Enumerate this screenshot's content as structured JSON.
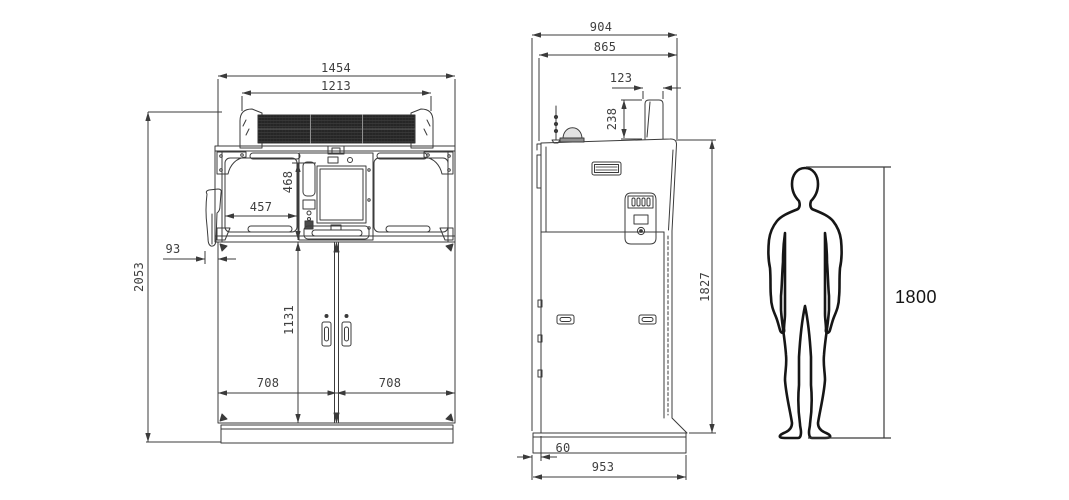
{
  "drawing": {
    "type": "technical-dimension-drawing",
    "units": "mm",
    "views": [
      "front view",
      "side view",
      "human figure scale reference"
    ]
  },
  "front_view": {
    "name": "Front view",
    "dims": {
      "overall_width": "1454",
      "grille_width": "1213",
      "overall_height": "2053",
      "console_panel_height": "468",
      "left_panel_width": "457",
      "holster_offset": "93",
      "door_height": "1131",
      "left_door_width": "708",
      "right_door_width": "708"
    }
  },
  "side_view": {
    "name": "Side view",
    "dims": {
      "overall_depth": "904",
      "body_depth": "865",
      "canopy_depth": "123",
      "canopy_height": "238",
      "body_height": "1827",
      "base_rear_offset": "60",
      "base_depth": "953"
    }
  },
  "human_figure": {
    "name": "Standing human silhouette for scale",
    "height": "1800"
  },
  "colors": {
    "line": "#3b3b3b",
    "text": "#3f3f3f",
    "grille_fill": "#262626",
    "silhouette": "#161616",
    "background": "#ffffff"
  }
}
